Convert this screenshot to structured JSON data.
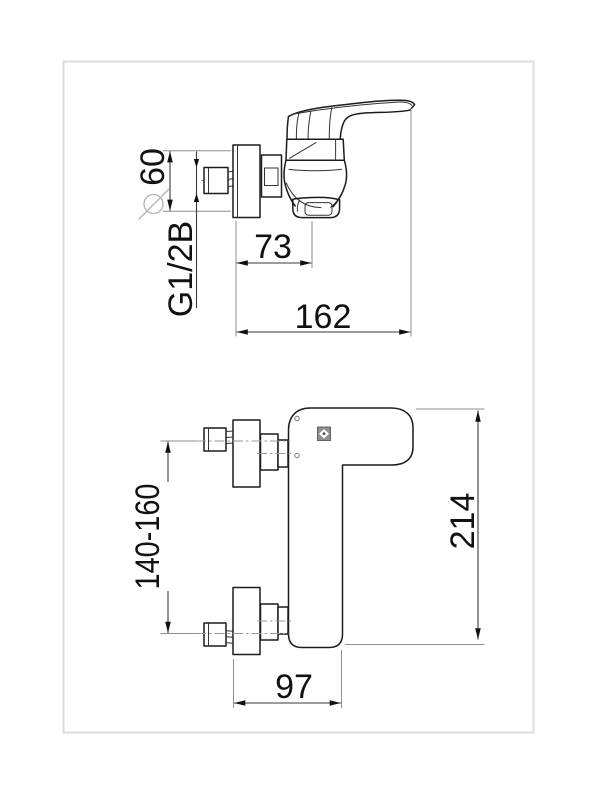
{
  "views": {
    "side": {
      "dims": {
        "diameter": {
          "symbol": "⌀",
          "value": "60"
        },
        "thread": {
          "value": "G1/2B"
        },
        "offset": {
          "value": "73"
        },
        "depth": {
          "value": "162"
        }
      }
    },
    "front": {
      "dims": {
        "spacing": {
          "value": "140-160"
        },
        "height": {
          "value": "214"
        },
        "width": {
          "value": "97"
        }
      }
    }
  },
  "icons": {
    "brand_logo": "brand-logo-mark",
    "diameter_symbol": "diameter-symbol"
  },
  "colors": {
    "background": "#ffffff",
    "outline": "#1c1c1c",
    "dimension": "#3a3a3a",
    "extension": "#8f8f8f",
    "centerline": "#999999",
    "frame": "#dcdcdc",
    "symbol_gray": "#b3b3b3"
  }
}
